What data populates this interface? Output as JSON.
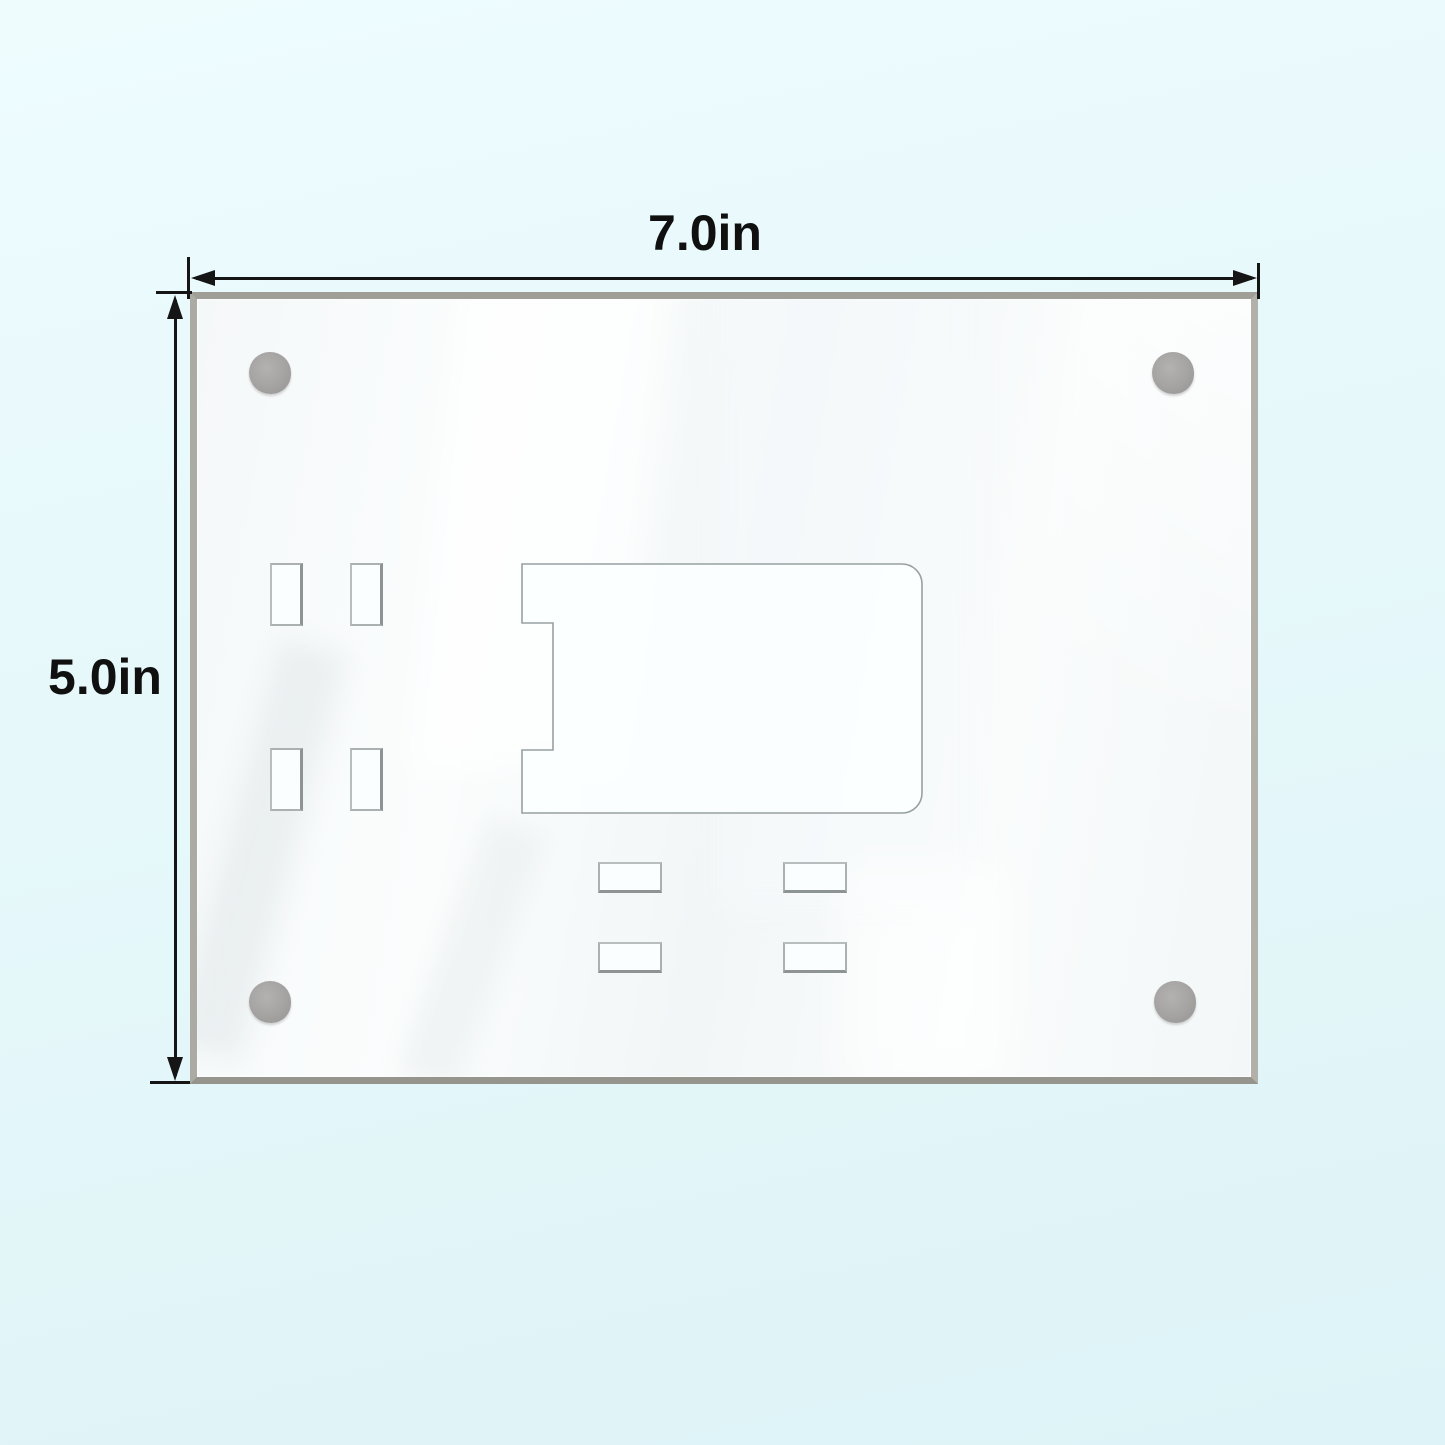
{
  "labels": {
    "width": "7.0in",
    "height": "5.0in"
  },
  "colors": {
    "background": "#e6f9fb",
    "panel_face": "#f7fafa",
    "panel_edge": "#a3a29a",
    "dimension_line": "#151515",
    "magnet_dot": "#a5a3a1",
    "cutout_outline": "#98a0a2"
  }
}
